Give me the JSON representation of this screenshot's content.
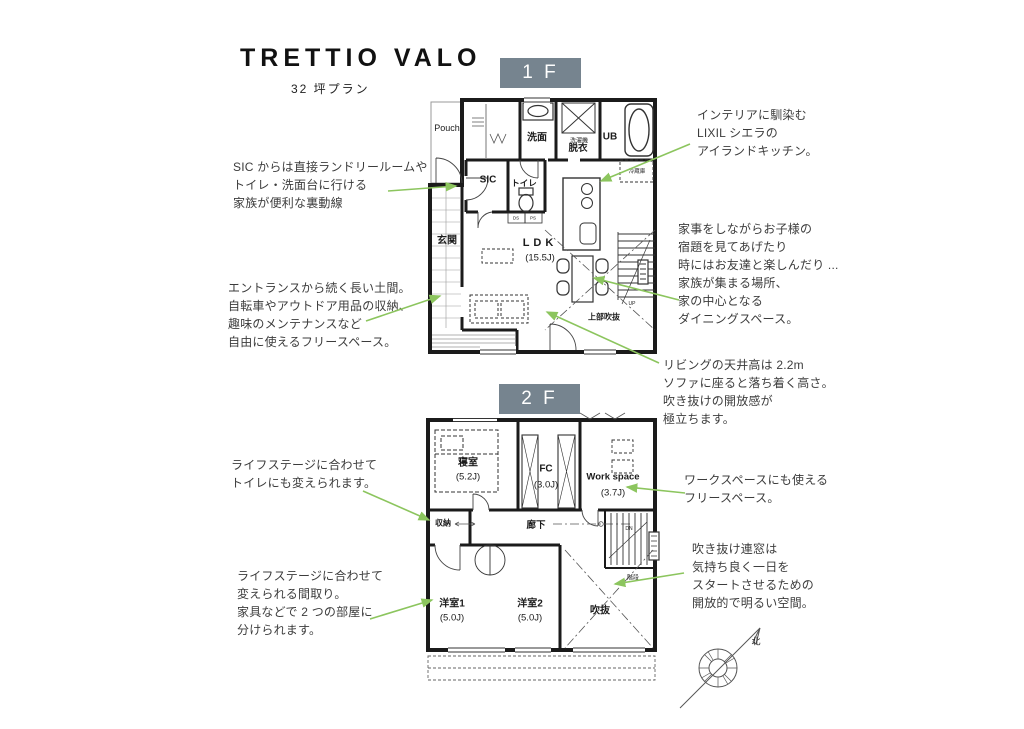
{
  "header": {
    "title": "TRETTIO VALO",
    "subtitle": "32 坪プラン"
  },
  "badges": {
    "f1": "1 F",
    "f2": "2 F"
  },
  "plan1f": {
    "pouch": "Pouch",
    "senmen": "洗面",
    "sentakuki": "洗濯機",
    "datsui": "脱衣",
    "ub": "UB",
    "sic": "SIC",
    "toire": "トイレ",
    "ds": "DS",
    "ps": "PS",
    "genkan": "玄関",
    "ldk": "LDK",
    "ldk_size": "(15.5J)",
    "reizouko": "冷蔵庫",
    "up": "UP",
    "joubufukinuke": "上部吹抜"
  },
  "plan2f": {
    "shinshitsu": "寝室",
    "shinshitsu_size": "(5.2J)",
    "fc": "FC",
    "fc_size": "(3.0J)",
    "workspace": "Work space",
    "workspace_size": "(3.7J)",
    "shuunou": "収納",
    "rouka": "廊下",
    "dn": "DN",
    "kaidan": "階段",
    "youshitsu1": "洋室1",
    "youshitsu1_size": "(5.0J)",
    "youshitsu2": "洋室2",
    "youshitsu2_size": "(5.0J)",
    "fukinuke": "吹抜"
  },
  "annotations": {
    "sic_route": "SIC からは直接ランドリールームや\nトイレ・洗面台に行ける\n家族が便利な裏動線",
    "doma": "エントランスから続く長い土間。\n自転車やアウトドア用品の収納、\n趣味のメンテナンスなど\n自由に使えるフリースペース。",
    "kitchen": "インテリアに馴染む\nLIXIL シエラの\nアイランドキッチン。",
    "dining": "家事をしながらお子様の\n宿題を見てあげたり\n時にはお友達と楽しんだり ...\n家族が集まる場所、\n家の中心となる\nダイニングスペース。",
    "living": "リビングの天井高は 2.2m\nソファに座ると落ち着く高さ。\n吹き抜けの開放感が\n極立ちます。",
    "toilet_2f": "ライフステージに合わせて\nトイレにも変えられます。",
    "rooms_2f": "ライフステージに合わせて\n変えられる間取り。\n家具などで 2 つの部屋に\n分けられます。",
    "workspace_2f": "ワークスペースにも使える\nフリースペース。",
    "void_window": "吹き抜け連窓は\n気持ち良く一日を\nスタートさせるための\n開放的で明るい空間。"
  },
  "compass": {
    "north": "北"
  },
  "colors": {
    "badge_bg": "#76848F",
    "arrow_green": "#8CC55E",
    "wall": "#1B1B1B"
  }
}
